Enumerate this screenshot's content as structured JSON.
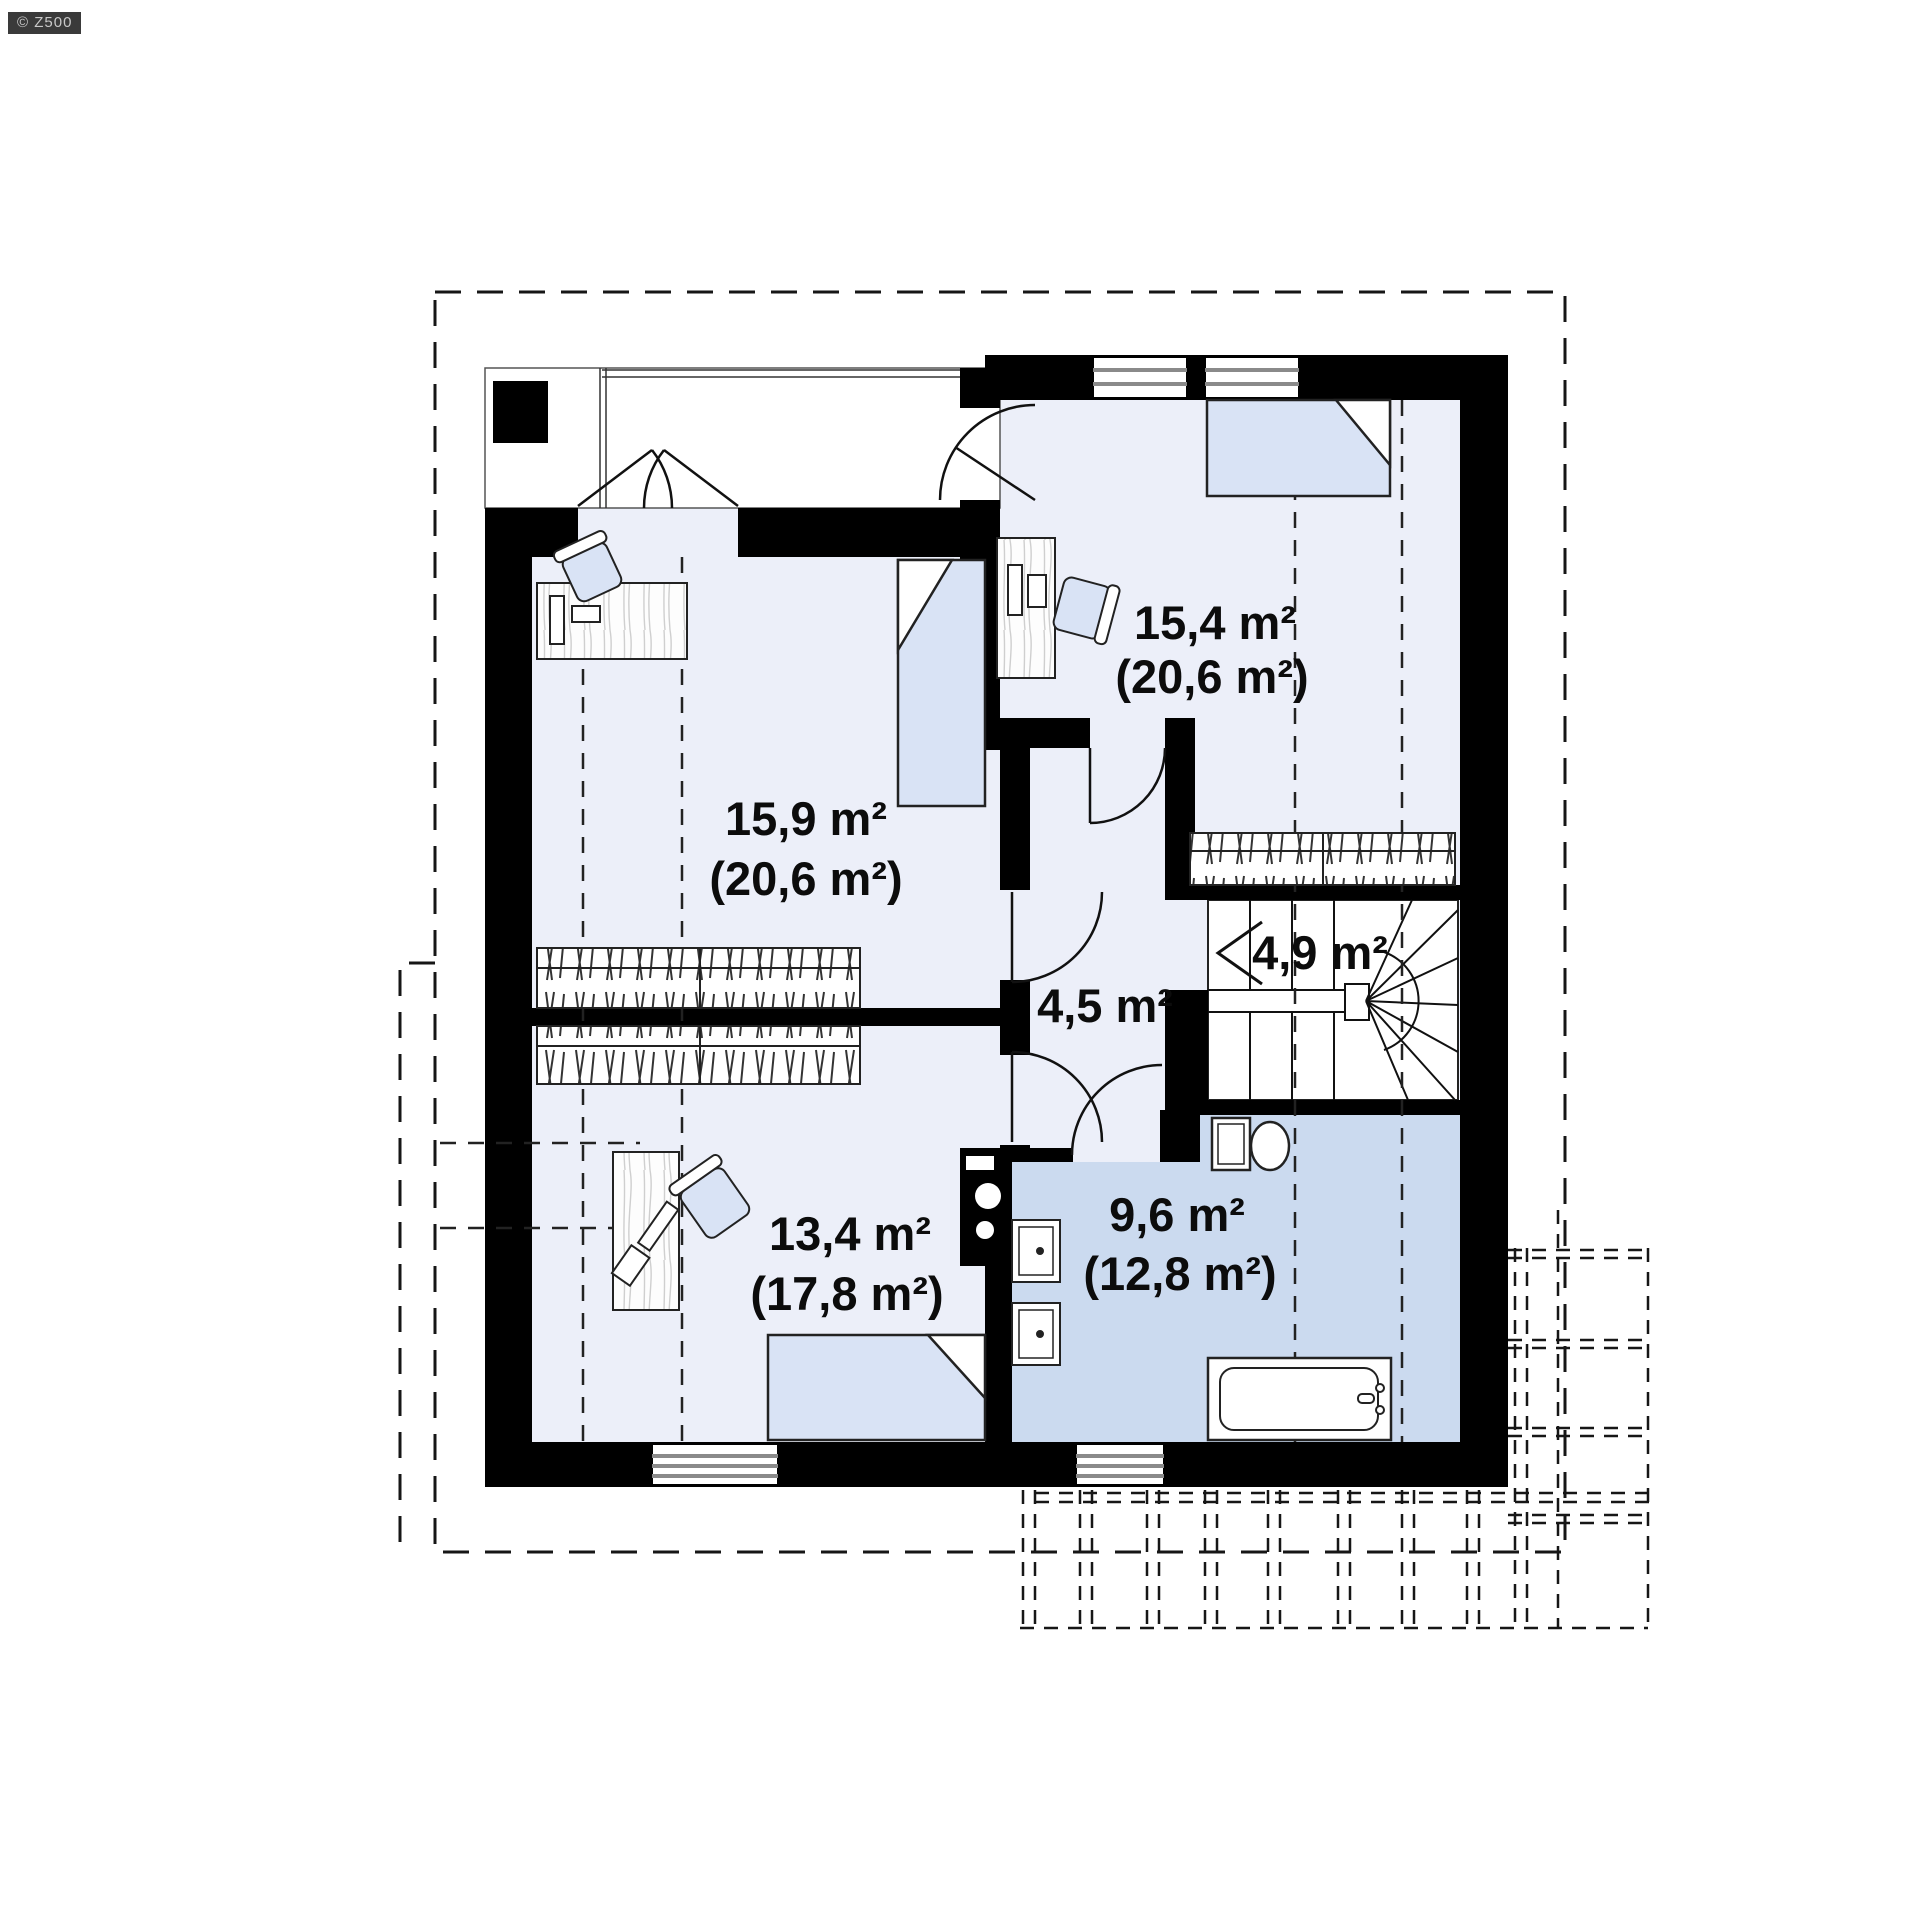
{
  "watermark": "© Z500",
  "plan": {
    "rooms": [
      {
        "id": "bedroom-upper-right",
        "area": "15,4 m²",
        "area_total": "(20,6 m²)"
      },
      {
        "id": "bedroom-left",
        "area": "15,9 m²",
        "area_total": "(20,6 m²)"
      },
      {
        "id": "hall",
        "area": "4,5 m²",
        "area_total": ""
      },
      {
        "id": "staircase",
        "area": "4,9 m²",
        "area_total": ""
      },
      {
        "id": "bedroom-lower-left",
        "area": "13,4 m²",
        "area_total": "(17,8 m²)"
      },
      {
        "id": "bathroom",
        "area": "9,6 m²",
        "area_total": "(12,8 m²)"
      }
    ],
    "colors": {
      "wall": "#000000",
      "room_fill": "#eceff9",
      "bathroom_fill": "#cbdaef",
      "furniture_fill": "#d9e3f5",
      "label": "#0c0c0c",
      "background": "#ffffff"
    }
  }
}
